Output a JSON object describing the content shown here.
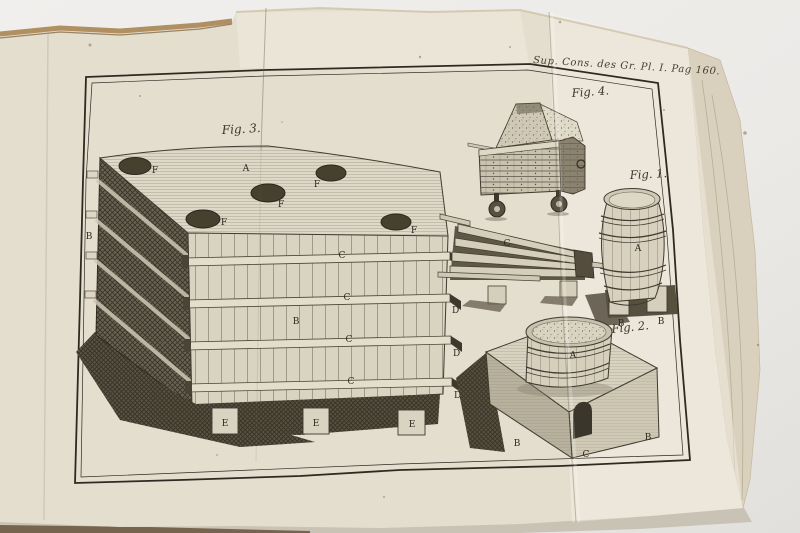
{
  "plate": {
    "caption": "Sup. Cons. des Gr. Pl. I. Pag 160.",
    "figures": {
      "fig3": {
        "label": "Fig. 3.",
        "top_center": "A",
        "holes": [
          "F",
          "F",
          "F",
          "F",
          "F"
        ],
        "margin": "B",
        "front": "B",
        "rails": [
          "C",
          "C",
          "C",
          "C"
        ],
        "rail_ends": [
          "D",
          "D",
          "D",
          "D"
        ],
        "feet": [
          "E",
          "E",
          "E"
        ]
      },
      "launder": {
        "letter": "C"
      },
      "fig4": {
        "label": "Fig. 4."
      },
      "fig1": {
        "label": "Fig. 1.",
        "body": "A",
        "feet": [
          "B",
          "B"
        ]
      },
      "fig2": {
        "label": "Fig. 2.",
        "tub": "A",
        "corners": [
          "B",
          "B"
        ],
        "door": "C"
      }
    },
    "colors": {
      "background": "#ecebe8",
      "paper": "#e4decf",
      "paper_light": "#ebe6d8",
      "ink": "#39332a",
      "page_edges": "#d9d1bd",
      "deckle_brown": "#b08f63",
      "shadow_dark": "#57503f"
    }
  }
}
